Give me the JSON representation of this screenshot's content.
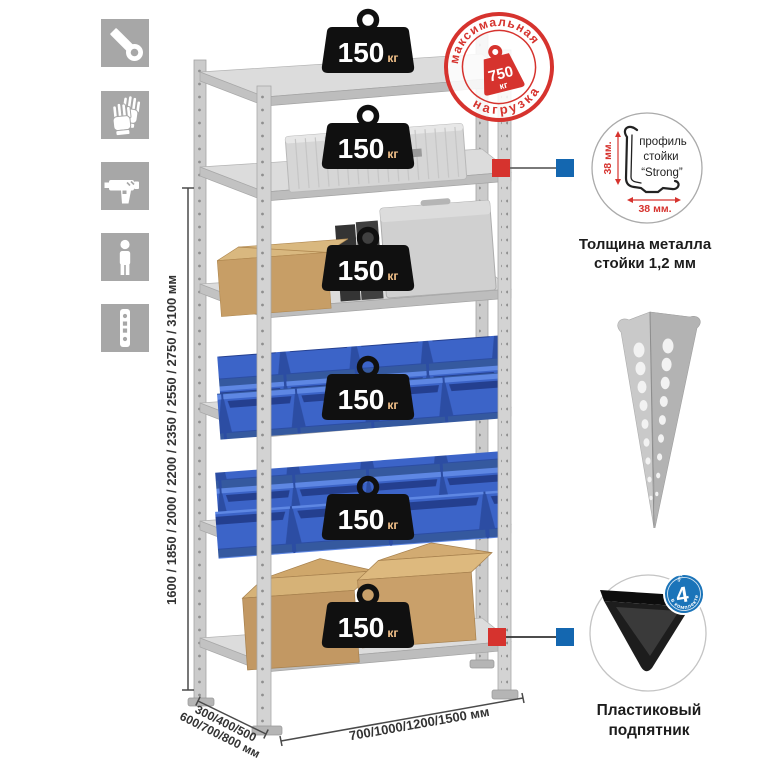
{
  "left_toolbar": {
    "icons": [
      {
        "name": "wrench-icon"
      },
      {
        "name": "work-gloves-icon"
      },
      {
        "name": "power-drill-icon"
      },
      {
        "name": "person-icon"
      },
      {
        "name": "rack-upright-icon"
      }
    ]
  },
  "stamp": {
    "arc_top": "максимальная",
    "arc_bottom": "нагрузка",
    "value": "750",
    "unit": "кг",
    "color": "#d6332e"
  },
  "load_badge": {
    "value": "150",
    "unit": "кг",
    "count_on_rack": 6
  },
  "dimensions": {
    "height": "1600 / 1850 / 2000 / 2200 / 2350 / 2550 / 2750 / 3100 мм",
    "depth_top": "300/400/500",
    "depth_bottom": "600/700/800 мм",
    "width": "700/1000/1200/1500 мм"
  },
  "profile_detail": {
    "label_line1": "профиль",
    "label_line2": "стойки",
    "label_line3": "“Strong”",
    "dim_vertical": "38 мм.",
    "dim_horizontal": "38 мм.",
    "caption_line1": "Толщина металла",
    "caption_line2": "стойки 1,2 мм"
  },
  "foot_detail": {
    "badge_count": "4",
    "badge_small": "штуки",
    "badge_arc": "в комплекте",
    "caption_line1": "Пластиковый",
    "caption_line2": "подпятник"
  },
  "colors": {
    "accent_red": "#d6332e",
    "marker_blue": "#1467b0",
    "badge_black": "#101010",
    "bin_blue": "#3c64c8",
    "steel_gray": "#d4d4d4",
    "icon_gray": "#a7a7a7",
    "cardboard": "#c79e66",
    "detail_badge_blue": "#1b74b9"
  }
}
